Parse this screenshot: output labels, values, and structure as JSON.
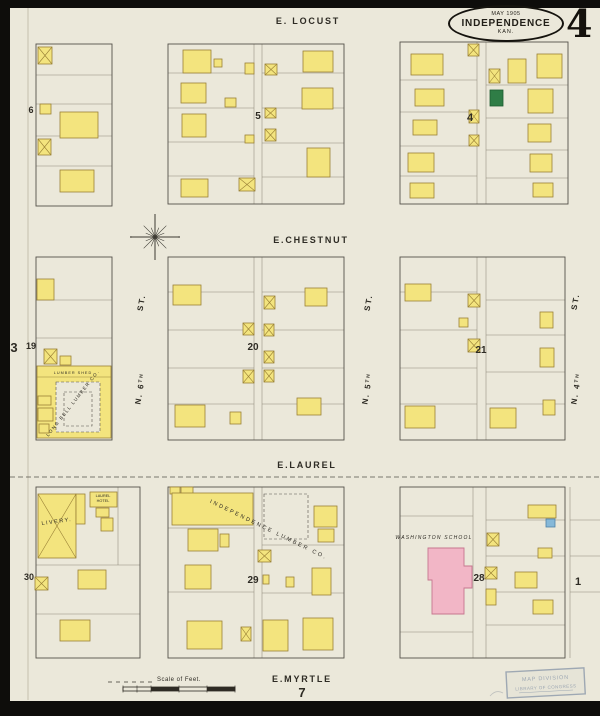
{
  "header": {
    "date": "MAY 1905",
    "city": "INDEPENDENCE",
    "state": "KAN.",
    "sheet": "4"
  },
  "colors": {
    "paper": "#ebe8da",
    "border": "#0e0d0b",
    "building_yellow": "#f3e47e",
    "building_outline": "#9a8136",
    "school_pink": "#f2b6c6",
    "school_outline": "#c7768f",
    "special_green": "#2f7d46",
    "special_blue": "#85b8d8",
    "line": "#55514a",
    "lot_line": "#8f897a",
    "text": "#2e2b24",
    "stamp": "#8593a6"
  },
  "streets": [
    {
      "name": "e-locust",
      "text": "E. LOCUST",
      "x": 308,
      "y": 24,
      "size": 9
    },
    {
      "name": "e-chestnut",
      "text": "E.CHESTNUT",
      "x": 311,
      "y": 243,
      "size": 9
    },
    {
      "name": "e-laurel",
      "text": "E.LAUREL",
      "x": 307,
      "y": 468,
      "size": 9
    },
    {
      "name": "e-myrtle",
      "text": "E.MYRTLE",
      "x": 302,
      "y": 682,
      "size": 9
    },
    {
      "name": "n-6th-st",
      "text": "ST.",
      "x": 144,
      "y": 303,
      "size": 8,
      "rotate": -80
    },
    {
      "name": "n-6th",
      "text": "N. 6",
      "sup": "TH",
      "x": 143,
      "y": 389,
      "size": 8,
      "rotate": -80
    },
    {
      "name": "n-5th-st",
      "text": "ST.",
      "x": 371,
      "y": 303,
      "size": 8,
      "rotate": -80
    },
    {
      "name": "n-5th",
      "text": "N. 5",
      "sup": "TH",
      "x": 370,
      "y": 389,
      "size": 8,
      "rotate": -80
    },
    {
      "name": "n-4th-st",
      "text": "ST.",
      "x": 578,
      "y": 302,
      "size": 8,
      "rotate": -80
    },
    {
      "name": "n-4th",
      "text": "N. 4",
      "sup": "TH",
      "x": 579,
      "y": 389,
      "size": 8,
      "rotate": -80
    }
  ],
  "block_numbers": [
    {
      "text": "6",
      "x": 31,
      "y": 113,
      "size": 9
    },
    {
      "text": "5",
      "x": 258,
      "y": 119,
      "size": 10
    },
    {
      "text": "4",
      "x": 470,
      "y": 121,
      "size": 11
    },
    {
      "text": "19",
      "x": 31,
      "y": 349,
      "size": 9
    },
    {
      "text": "20",
      "x": 253,
      "y": 350,
      "size": 10
    },
    {
      "text": "21",
      "x": 481,
      "y": 353,
      "size": 10
    },
    {
      "text": "30",
      "x": 29,
      "y": 580,
      "size": 9
    },
    {
      "text": "29",
      "x": 253,
      "y": 583,
      "size": 10
    },
    {
      "text": "28",
      "x": 479,
      "y": 581,
      "size": 10
    }
  ],
  "sheet_refs": [
    {
      "text": "3",
      "x": 14,
      "y": 352,
      "size": 13
    },
    {
      "text": "1",
      "x": 578,
      "y": 585,
      "size": 11
    },
    {
      "text": "7",
      "x": 302,
      "y": 697,
      "size": 13
    }
  ],
  "landmarks": [
    {
      "name": "livery-label",
      "text": "LIVERY.",
      "x": 57,
      "y": 523,
      "size": 5.5,
      "rotate": -8,
      "spacing": 1.5
    },
    {
      "name": "laurel-hotel-label-1",
      "text": "LAUREL",
      "x": 103,
      "y": 497,
      "size": 3.8
    },
    {
      "name": "laurel-hotel-label-2",
      "text": "HOTEL",
      "x": 103,
      "y": 502,
      "size": 3.8
    },
    {
      "name": "independence-lumber-label",
      "text": "INDEPENDENCE LUMBER CO.",
      "x": 268,
      "y": 531,
      "size": 5.5,
      "rotate": 26,
      "spacing": 2.2
    },
    {
      "name": "long-bell-lumber-label",
      "text": "LONG BELL LUMBER CO.",
      "x": 74,
      "y": 404,
      "size": 4.6,
      "rotate": -52,
      "spacing": 1.4
    },
    {
      "name": "lumber-shed-label",
      "text": "LUMBER SHED",
      "x": 73,
      "y": 374,
      "size": 3.8,
      "spacing": 1
    },
    {
      "name": "washington-school-label",
      "text": "WASHINGTON SCHOOL",
      "x": 434,
      "y": 539,
      "size": 5,
      "italic": true,
      "spacing": 1.2
    }
  ],
  "scale": {
    "label": "Scale of Feet.",
    "x": 179,
    "y": 681,
    "bar": {
      "x": 123,
      "y": 687,
      "w": 112,
      "h": 4
    }
  },
  "stamp": {
    "x": 506,
    "y": 672,
    "w": 78,
    "h": 26,
    "rotate": -3,
    "lines": [
      "MAP DIVISION",
      "LIBRARY OF CONGRESS"
    ]
  },
  "map": {
    "paper": {
      "x": 10,
      "y": 8,
      "w": 590,
      "h": 693
    },
    "margin_line": [
      28,
      8,
      28,
      700
    ],
    "compass": {
      "cx": 155,
      "cy": 237
    },
    "blocks": [
      [
        36,
        44,
        76,
        162
      ],
      [
        168,
        44,
        176,
        160
      ],
      [
        400,
        42,
        168,
        162
      ],
      [
        36,
        257,
        76,
        183
      ],
      [
        168,
        257,
        176,
        183
      ],
      [
        400,
        257,
        165,
        183
      ],
      [
        36,
        487,
        104,
        171
      ],
      [
        168,
        487,
        176,
        171
      ],
      [
        400,
        487,
        165,
        171
      ]
    ],
    "lines": [
      [
        36,
        75,
        112,
        75
      ],
      [
        36,
        104,
        112,
        104
      ],
      [
        36,
        136,
        112,
        136
      ],
      [
        36,
        166,
        112,
        166
      ],
      [
        168,
        73,
        254,
        73
      ],
      [
        168,
        108,
        254,
        108
      ],
      [
        168,
        142,
        254,
        142
      ],
      [
        168,
        176,
        254,
        176
      ],
      [
        262,
        73,
        344,
        73
      ],
      [
        262,
        108,
        344,
        108
      ],
      [
        262,
        143,
        344,
        143
      ],
      [
        262,
        177,
        344,
        177
      ],
      [
        254,
        44,
        254,
        204
      ],
      [
        262,
        44,
        262,
        204
      ],
      [
        400,
        80,
        477,
        80
      ],
      [
        400,
        112,
        477,
        112
      ],
      [
        400,
        146,
        477,
        146
      ],
      [
        400,
        176,
        477,
        176
      ],
      [
        486,
        85,
        568,
        85
      ],
      [
        486,
        118,
        568,
        118
      ],
      [
        486,
        150,
        568,
        150
      ],
      [
        486,
        178,
        568,
        178
      ],
      [
        477,
        42,
        477,
        204
      ],
      [
        486,
        42,
        486,
        204
      ],
      [
        36,
        300,
        112,
        300
      ],
      [
        36,
        338,
        112,
        338
      ],
      [
        168,
        292,
        254,
        292
      ],
      [
        168,
        330,
        254,
        330
      ],
      [
        168,
        368,
        254,
        368
      ],
      [
        168,
        404,
        254,
        404
      ],
      [
        262,
        292,
        344,
        292
      ],
      [
        262,
        330,
        344,
        330
      ],
      [
        262,
        368,
        344,
        368
      ],
      [
        262,
        404,
        344,
        404
      ],
      [
        254,
        257,
        254,
        440
      ],
      [
        262,
        257,
        262,
        440
      ],
      [
        400,
        292,
        477,
        292
      ],
      [
        400,
        330,
        477,
        330
      ],
      [
        400,
        368,
        477,
        368
      ],
      [
        400,
        404,
        477,
        404
      ],
      [
        486,
        300,
        565,
        300
      ],
      [
        486,
        335,
        565,
        335
      ],
      [
        486,
        372,
        565,
        372
      ],
      [
        486,
        404,
        565,
        404
      ],
      [
        477,
        257,
        477,
        440
      ],
      [
        486,
        257,
        486,
        440
      ],
      [
        36,
        565,
        140,
        565
      ],
      [
        36,
        614,
        140,
        614
      ],
      [
        118,
        487,
        118,
        565
      ],
      [
        168,
        528,
        254,
        528
      ],
      [
        168,
        592,
        254,
        592
      ],
      [
        262,
        545,
        344,
        545
      ],
      [
        262,
        593,
        344,
        593
      ],
      [
        254,
        487,
        254,
        658
      ],
      [
        262,
        487,
        262,
        658
      ],
      [
        473,
        487,
        473,
        658
      ],
      [
        486,
        487,
        486,
        658
      ],
      [
        400,
        516,
        473,
        516
      ],
      [
        400,
        632,
        473,
        632
      ],
      [
        486,
        520,
        565,
        520
      ],
      [
        486,
        556,
        565,
        556
      ],
      [
        486,
        592,
        565,
        592
      ],
      [
        486,
        625,
        565,
        625
      ],
      [
        570,
        487,
        570,
        658
      ],
      [
        570,
        520,
        600,
        520
      ],
      [
        570,
        556,
        600,
        556
      ],
      [
        570,
        592,
        600,
        592
      ]
    ],
    "overlay_lines": [
      [
        37,
        377,
        111,
        377
      ]
    ],
    "dashed_lines": [
      [
        10,
        477,
        600,
        477
      ]
    ],
    "dashed_rects": [
      [
        56,
        382,
        44,
        50
      ],
      [
        64,
        392,
        28,
        34
      ],
      [
        264,
        494,
        44,
        45
      ]
    ],
    "school_polygon": [
      [
        428,
        548
      ],
      [
        464,
        548
      ],
      [
        464,
        566
      ],
      [
        472,
        566
      ],
      [
        472,
        588
      ],
      [
        464,
        588
      ],
      [
        464,
        614
      ],
      [
        432,
        614
      ],
      [
        432,
        580
      ],
      [
        428,
        580
      ]
    ],
    "buildings": [
      [
        38,
        47,
        14,
        17,
        "x"
      ],
      [
        40,
        104,
        11,
        10,
        "y"
      ],
      [
        60,
        112,
        38,
        26,
        "y"
      ],
      [
        38,
        139,
        13,
        16,
        "x"
      ],
      [
        60,
        170,
        34,
        22,
        "y"
      ],
      [
        183,
        50,
        28,
        23,
        "y"
      ],
      [
        214,
        59,
        8,
        8,
        "y"
      ],
      [
        245,
        63,
        9,
        11,
        "y"
      ],
      [
        265,
        64,
        12,
        11,
        "x"
      ],
      [
        303,
        51,
        30,
        21,
        "y"
      ],
      [
        181,
        83,
        25,
        20,
        "y"
      ],
      [
        225,
        98,
        11,
        9,
        "y"
      ],
      [
        302,
        88,
        31,
        21,
        "y"
      ],
      [
        265,
        108,
        11,
        10,
        "x"
      ],
      [
        182,
        114,
        24,
        23,
        "y"
      ],
      [
        265,
        129,
        11,
        12,
        "x"
      ],
      [
        245,
        135,
        9,
        8,
        "y"
      ],
      [
        307,
        148,
        23,
        29,
        "y"
      ],
      [
        239,
        178,
        16,
        13,
        "x"
      ],
      [
        181,
        179,
        27,
        18,
        "y"
      ],
      [
        411,
        54,
        32,
        21,
        "y"
      ],
      [
        468,
        44,
        11,
        12,
        "x"
      ],
      [
        508,
        59,
        18,
        24,
        "y"
      ],
      [
        537,
        54,
        25,
        24,
        "y"
      ],
      [
        489,
        69,
        11,
        14,
        "x"
      ],
      [
        415,
        89,
        29,
        17,
        "y"
      ],
      [
        490,
        90,
        13,
        16,
        "g"
      ],
      [
        528,
        89,
        25,
        24,
        "y"
      ],
      [
        413,
        120,
        24,
        15,
        "y"
      ],
      [
        469,
        110,
        10,
        13,
        "x"
      ],
      [
        528,
        124,
        23,
        18,
        "y"
      ],
      [
        469,
        135,
        10,
        11,
        "x"
      ],
      [
        408,
        153,
        26,
        19,
        "y"
      ],
      [
        530,
        154,
        22,
        18,
        "y"
      ],
      [
        410,
        183,
        24,
        15,
        "y"
      ],
      [
        533,
        183,
        20,
        14,
        "y"
      ],
      [
        37,
        279,
        17,
        21,
        "y"
      ],
      [
        44,
        349,
        13,
        15,
        "x"
      ],
      [
        60,
        356,
        11,
        9,
        "y"
      ],
      [
        37,
        366,
        74,
        72,
        "y"
      ],
      [
        38,
        396,
        13,
        9,
        "y"
      ],
      [
        38,
        408,
        15,
        13,
        "y"
      ],
      [
        39,
        424,
        10,
        9,
        "y"
      ],
      [
        173,
        285,
        28,
        20,
        "y"
      ],
      [
        305,
        288,
        22,
        18,
        "y"
      ],
      [
        264,
        296,
        11,
        13,
        "x"
      ],
      [
        243,
        323,
        11,
        12,
        "x"
      ],
      [
        264,
        324,
        10,
        12,
        "x"
      ],
      [
        264,
        351,
        10,
        12,
        "x"
      ],
      [
        243,
        370,
        11,
        13,
        "x"
      ],
      [
        264,
        370,
        10,
        12,
        "x"
      ],
      [
        297,
        398,
        24,
        17,
        "y"
      ],
      [
        175,
        405,
        30,
        22,
        "y"
      ],
      [
        230,
        412,
        11,
        12,
        "y"
      ],
      [
        405,
        284,
        26,
        17,
        "y"
      ],
      [
        468,
        294,
        12,
        13,
        "x"
      ],
      [
        459,
        318,
        9,
        9,
        "y"
      ],
      [
        468,
        339,
        12,
        13,
        "x"
      ],
      [
        540,
        312,
        13,
        16,
        "y"
      ],
      [
        540,
        348,
        14,
        19,
        "y"
      ],
      [
        405,
        406,
        30,
        22,
        "y"
      ],
      [
        490,
        408,
        26,
        20,
        "y"
      ],
      [
        543,
        400,
        12,
        15,
        "y"
      ],
      [
        38,
        494,
        38,
        64,
        "x"
      ],
      [
        76,
        494,
        9,
        30,
        "y"
      ],
      [
        90,
        492,
        27,
        15,
        "y"
      ],
      [
        96,
        508,
        13,
        9,
        "y"
      ],
      [
        101,
        518,
        12,
        13,
        "y"
      ],
      [
        35,
        577,
        13,
        13,
        "x"
      ],
      [
        78,
        570,
        28,
        19,
        "y"
      ],
      [
        60,
        620,
        30,
        21,
        "y"
      ],
      [
        170,
        487,
        10,
        7,
        "y"
      ],
      [
        181,
        487,
        12,
        7,
        "y"
      ],
      [
        172,
        493,
        81,
        32,
        "y"
      ],
      [
        188,
        529,
        30,
        22,
        "y"
      ],
      [
        220,
        534,
        9,
        13,
        "y"
      ],
      [
        258,
        550,
        13,
        12,
        "x"
      ],
      [
        314,
        506,
        23,
        21,
        "y"
      ],
      [
        318,
        529,
        16,
        13,
        "y"
      ],
      [
        185,
        565,
        26,
        24,
        "y"
      ],
      [
        263,
        575,
        6,
        9,
        "y"
      ],
      [
        286,
        577,
        8,
        10,
        "y"
      ],
      [
        312,
        568,
        19,
        27,
        "y"
      ],
      [
        241,
        627,
        10,
        14,
        "x"
      ],
      [
        187,
        621,
        35,
        28,
        "y"
      ],
      [
        263,
        620,
        25,
        31,
        "y"
      ],
      [
        303,
        618,
        30,
        32,
        "y"
      ],
      [
        487,
        533,
        12,
        13,
        "x"
      ],
      [
        485,
        567,
        12,
        12,
        "x"
      ],
      [
        486,
        589,
        10,
        16,
        "y"
      ],
      [
        528,
        505,
        28,
        13,
        "y"
      ],
      [
        546,
        519,
        9,
        8,
        "b"
      ],
      [
        538,
        548,
        14,
        10,
        "y"
      ],
      [
        515,
        572,
        22,
        16,
        "y"
      ],
      [
        533,
        600,
        20,
        14,
        "y"
      ]
    ]
  }
}
